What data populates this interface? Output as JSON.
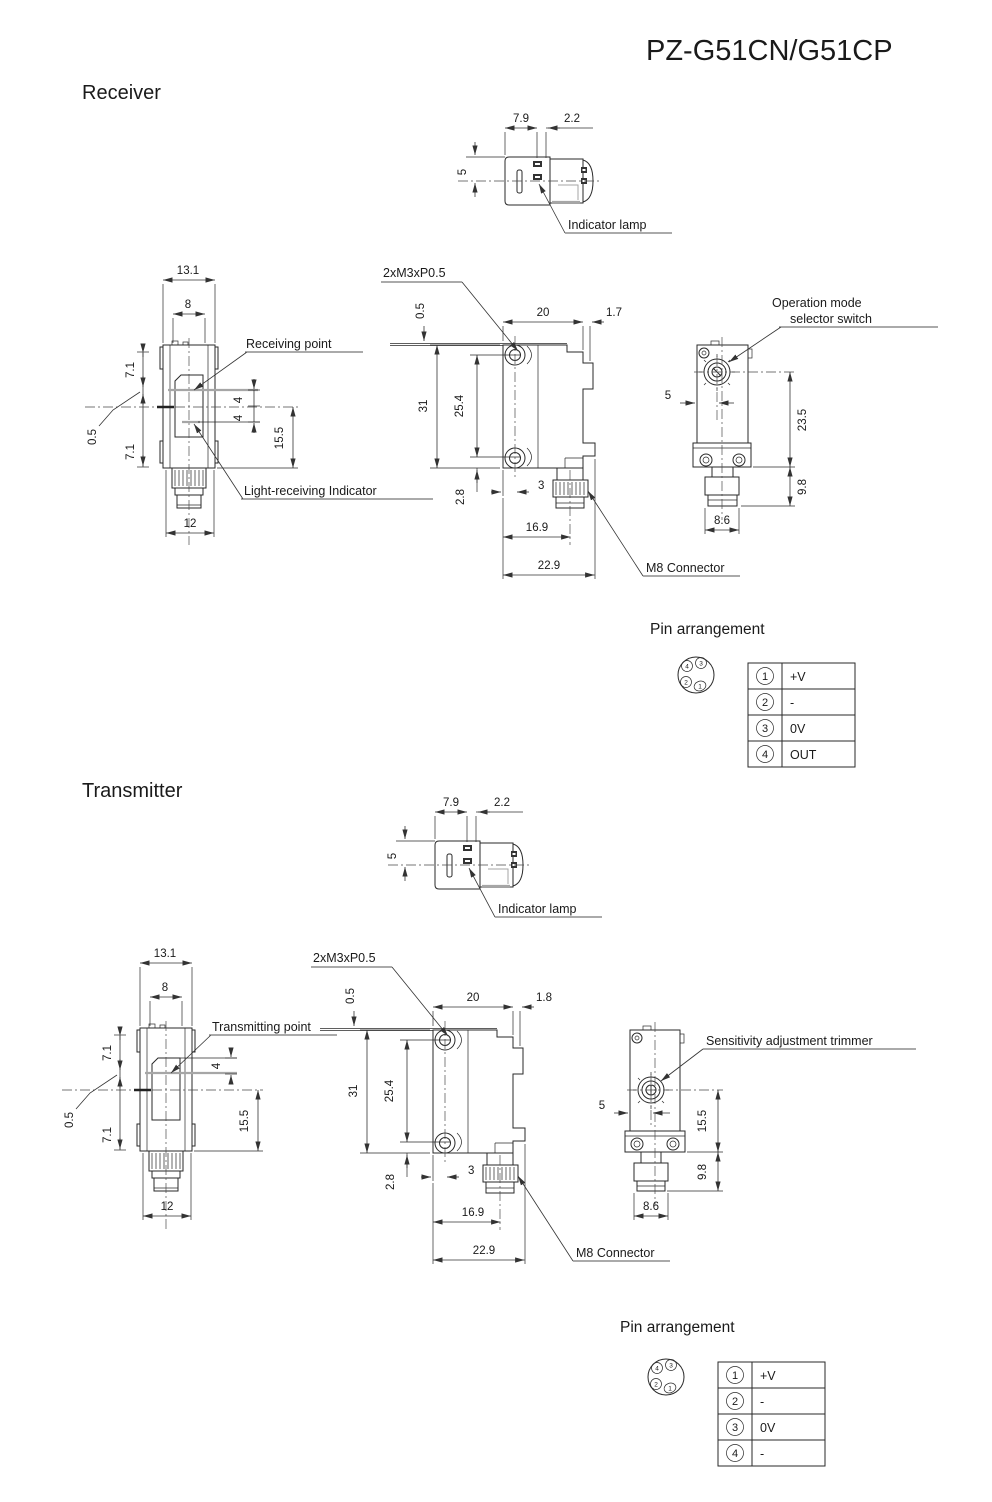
{
  "title": "PZ-G51CN/G51CP",
  "receiver": {
    "heading": "Receiver",
    "top": {
      "w1": "7.9",
      "w2": "2.2",
      "h": "5",
      "lamp": "Indicator lamp"
    },
    "front": {
      "w": "13.1",
      "win": "8",
      "t1": "7.1",
      "gap": "0.5",
      "t2": "7.1",
      "point": "Receiving point",
      "a1": "4",
      "a2": "4",
      "b": "15.5",
      "ind": "Light-receiving Indicator",
      "bw": "12"
    },
    "side": {
      "screw": "2xM3xP0.5",
      "plate": "0.5",
      "w": "20",
      "tab": "1.7",
      "h": "31",
      "hole": "25.4",
      "foot": "2.8",
      "f": "3",
      "c1": "16.9",
      "c2": "22.9",
      "m8": "M8 Connector"
    },
    "rear": {
      "l1": "Operation mode",
      "l2": "selector switch",
      "off": "5",
      "h1": "23.5",
      "h2": "9.8",
      "w": "8.6"
    },
    "pins": {
      "title": "Pin arrangement",
      "plug": [
        "4",
        "3",
        "2",
        "1"
      ],
      "rows": [
        {
          "n": "1",
          "v": "+V"
        },
        {
          "n": "2",
          "v": "-"
        },
        {
          "n": "3",
          "v": "0V"
        },
        {
          "n": "4",
          "v": "OUT"
        }
      ]
    }
  },
  "transmitter": {
    "heading": "Transmitter",
    "top": {
      "w1": "7.9",
      "w2": "2.2",
      "h": "5",
      "lamp": "Indicator lamp"
    },
    "front": {
      "w": "13.1",
      "win": "8",
      "t1": "7.1",
      "gap": "0.5",
      "t2": "7.1",
      "point": "Transmitting point",
      "a1": "4",
      "b": "15.5",
      "bw": "12"
    },
    "side": {
      "screw": "2xM3xP0.5",
      "plate": "0.5",
      "w": "20",
      "tab": "1.8",
      "h": "31",
      "hole": "25.4",
      "foot": "2.8",
      "f": "3",
      "c1": "16.9",
      "c2": "22.9",
      "m8": "M8 Connector"
    },
    "rear": {
      "l1": "Sensitivity adjustment trimmer",
      "off": "5",
      "h1": "15.5",
      "h2": "9.8",
      "w": "8.6"
    },
    "pins": {
      "title": "Pin arrangement",
      "plug": [
        "4",
        "3",
        "2",
        "1"
      ],
      "rows": [
        {
          "n": "1",
          "v": "+V"
        },
        {
          "n": "2",
          "v": "-"
        },
        {
          "n": "3",
          "v": "0V"
        },
        {
          "n": "4",
          "v": "-"
        }
      ]
    }
  }
}
